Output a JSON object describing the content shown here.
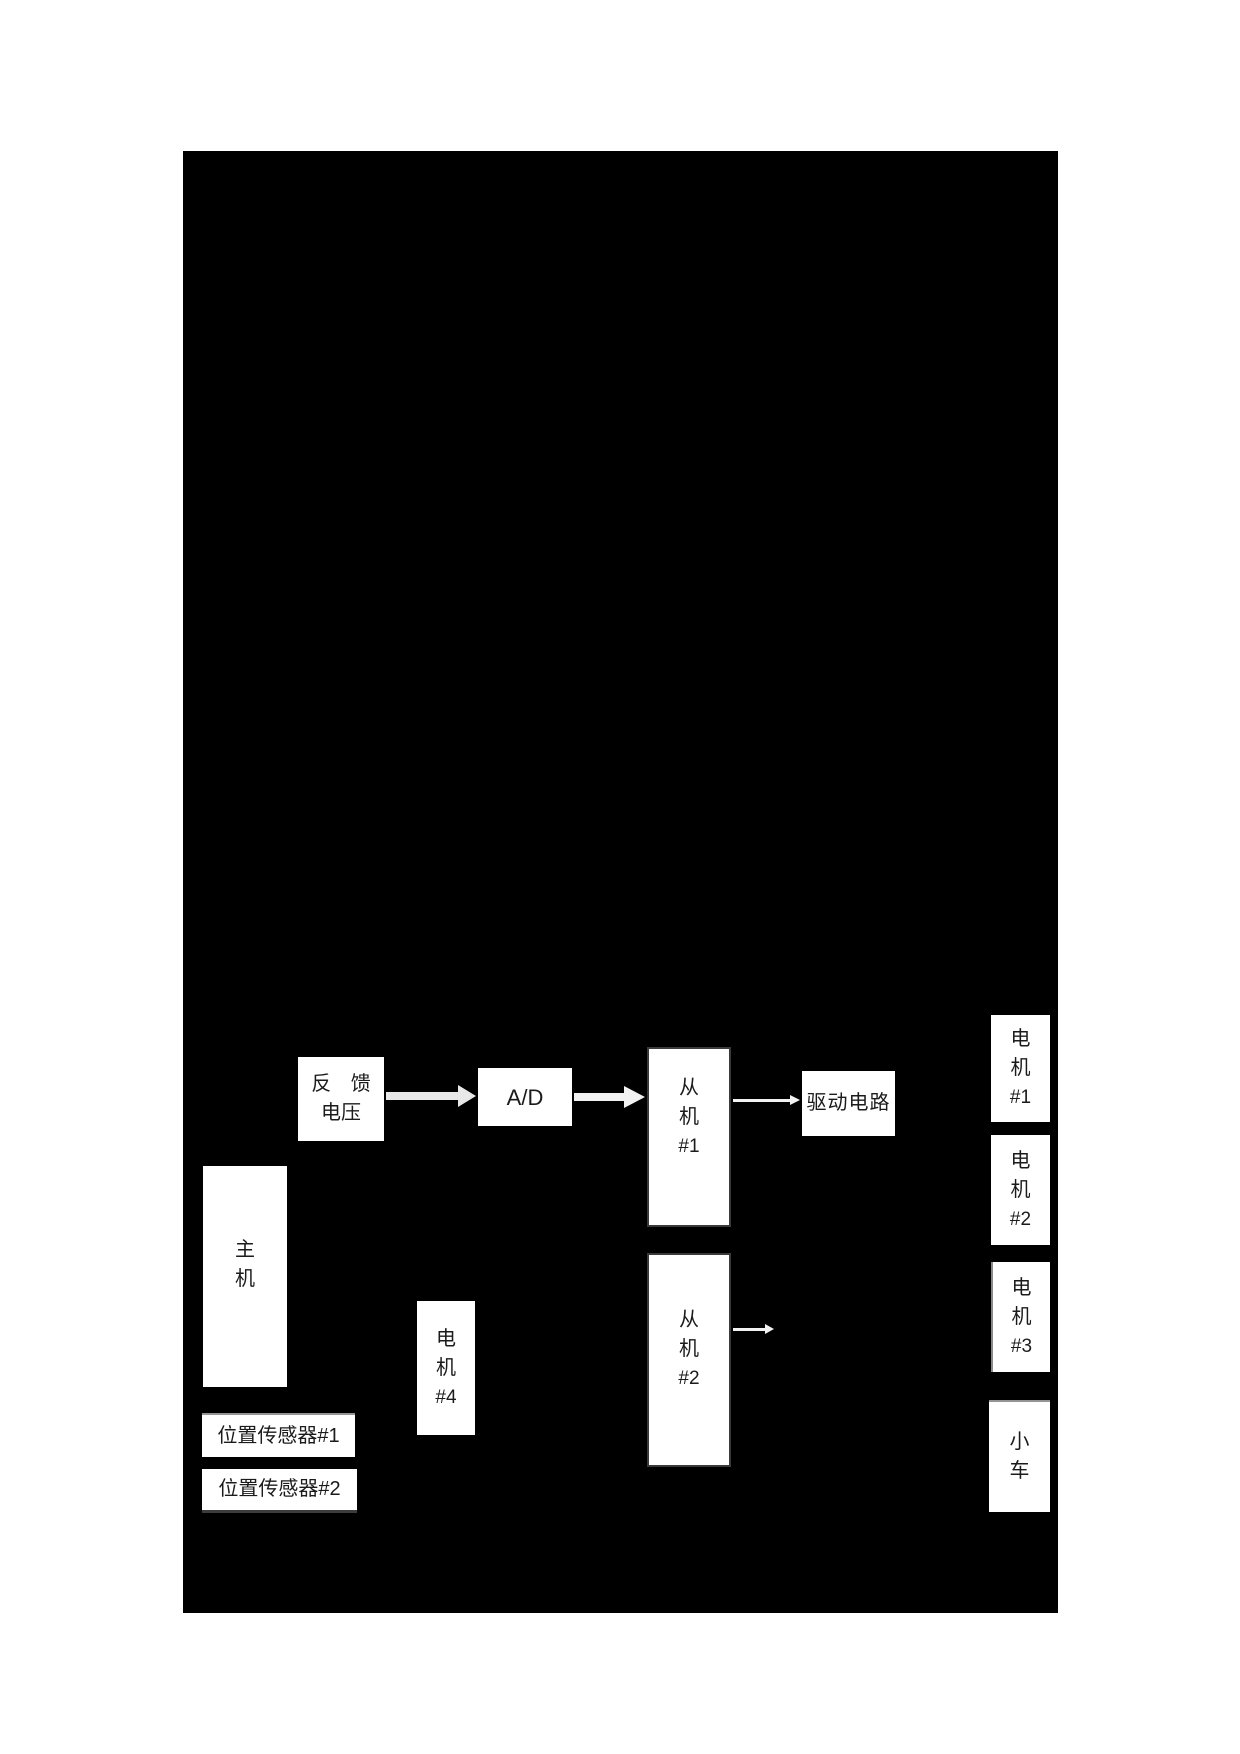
{
  "diagram": {
    "colors": {
      "page_bg": "#ffffff",
      "canvas_bg": "#000000",
      "node_bg": "#ffffff",
      "node_border": "#3a3a3a",
      "text": "#1b1b1b",
      "arrow": "#e8e8e8"
    },
    "nodes": {
      "feedback_voltage": {
        "lines": [
          "反 馈",
          "电压"
        ]
      },
      "ad_converter": {
        "label": "A/D"
      },
      "slave_1": {
        "lines": [
          "从",
          "机",
          "#1"
        ]
      },
      "drive_circuit": {
        "label": "驱动电路"
      },
      "motor_1": {
        "lines": [
          "电",
          "机",
          "#1"
        ]
      },
      "motor_2": {
        "lines": [
          "电",
          "机",
          "#2"
        ]
      },
      "motor_3": {
        "lines": [
          "电",
          "机",
          "#3"
        ]
      },
      "cart": {
        "lines": [
          "小",
          "车"
        ]
      },
      "master": {
        "lines": [
          "主",
          "机"
        ]
      },
      "motor_4": {
        "lines": [
          "电",
          "机",
          "#4"
        ]
      },
      "slave_2": {
        "lines": [
          "从",
          "机",
          "#2"
        ]
      },
      "position_sensor_1": {
        "label": "位置传感器#1"
      },
      "position_sensor_2": {
        "label": "位置传感器#2"
      }
    },
    "connections": [
      {
        "from": "feedback_voltage",
        "to": "ad_converter",
        "style": "block-arrow"
      },
      {
        "from": "ad_converter",
        "to": "slave_1",
        "style": "block-arrow"
      },
      {
        "from": "slave_1",
        "to": "drive_circuit",
        "style": "thin-arrow"
      },
      {
        "from": "slave_2",
        "to": null,
        "style": "thin-arrow"
      }
    ]
  }
}
